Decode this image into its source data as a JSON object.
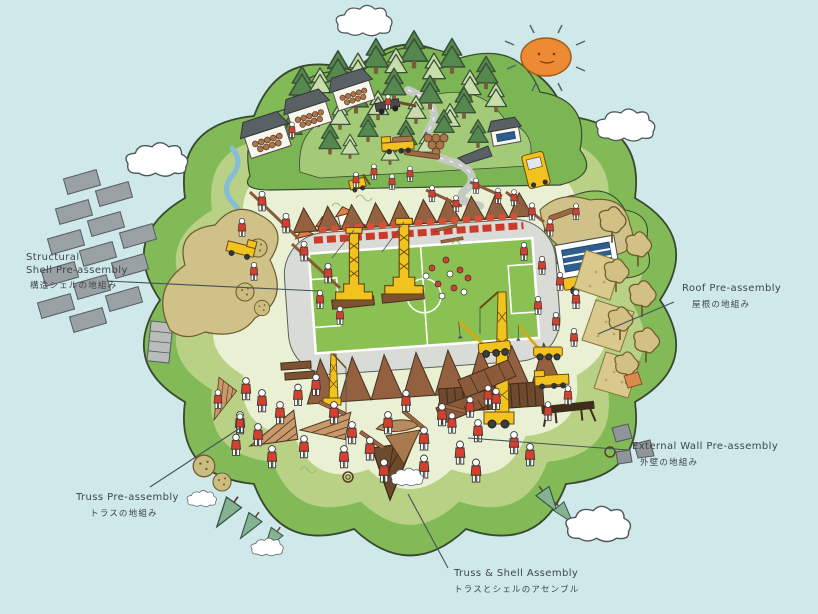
{
  "canvas": {
    "background_color": "#cfe8ea",
    "description": "Hand-drawn circular island construction scene with timber stadium assembly"
  },
  "colors": {
    "sky": "#cfe8ea",
    "island_rim": "#83ba58",
    "island_mid": "#b9d185",
    "island_core": "#eaf0d4",
    "field_green": "#8bc152",
    "crane_yellow": "#f2c31f",
    "worker_red": "#d5402e",
    "timber_brown": "#936040",
    "sun_orange": "#ec8b33",
    "label_ink": "#3d474c"
  },
  "scene_elements": [
    "sun-icon",
    "cloud-icon",
    "pine-tree-icon",
    "tan-tree-icon",
    "worker-figure",
    "tower-crane",
    "mobile-crane",
    "timber-truss",
    "soccer-field",
    "crowd-stand",
    "log-shed",
    "log-pile",
    "gray-slab-panel",
    "roof-panel",
    "wall-panel",
    "stream",
    "road",
    "stone",
    "rim-cone-tree"
  ],
  "annotations": [
    {
      "name": "structural-shell-pre-assembly",
      "en_line1": "Structural",
      "en_line2": "Shell Pre-assembly",
      "ja": "構造シェルの地組み"
    },
    {
      "name": "roof-pre-assembly",
      "en": "Roof Pre-assembly",
      "ja": "屋根の地組み"
    },
    {
      "name": "truss-pre-assembly",
      "en": "Truss Pre-assembly",
      "ja": "トラスの地組み"
    },
    {
      "name": "external-wall-pre-assembly",
      "en": "External Wall Pre-assembly",
      "ja": "外壁の地組み"
    },
    {
      "name": "truss-and-shell-assembly",
      "en": "Truss & Shell Assembly",
      "ja": "トラスとシェルのアセンブル"
    }
  ]
}
